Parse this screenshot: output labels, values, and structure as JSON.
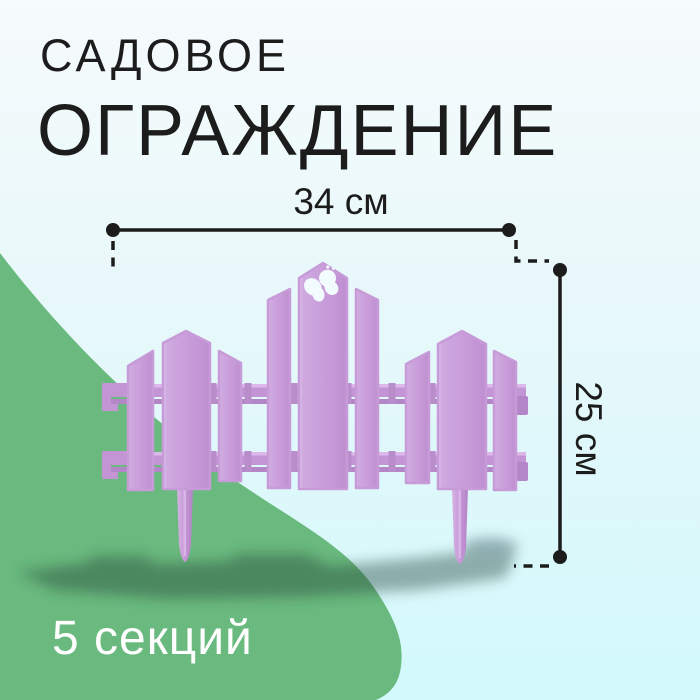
{
  "title": {
    "line1": "САДОВОЕ",
    "line2": "ОГРАЖДЕНИЕ"
  },
  "dimension_annotations": {
    "width_label": "34 см",
    "height_label": "25 см"
  },
  "badge": {
    "sections_label": "5 секций"
  },
  "illustration": {
    "subject": "декоративное садовое ограждение",
    "butterfly_icon": "butterfly-cutout"
  },
  "colors": {
    "background_top": "#f6fbfc",
    "background_bottom": "#d2f9fc",
    "accent_green": "#6ab97e",
    "fence_purple": "#c89cd9",
    "fence_purple_dark": "#b286c7",
    "fence_purple_light": "#ddc0ec",
    "annotation_black": "#1c1c1c",
    "badge_text": "#ffffff"
  }
}
